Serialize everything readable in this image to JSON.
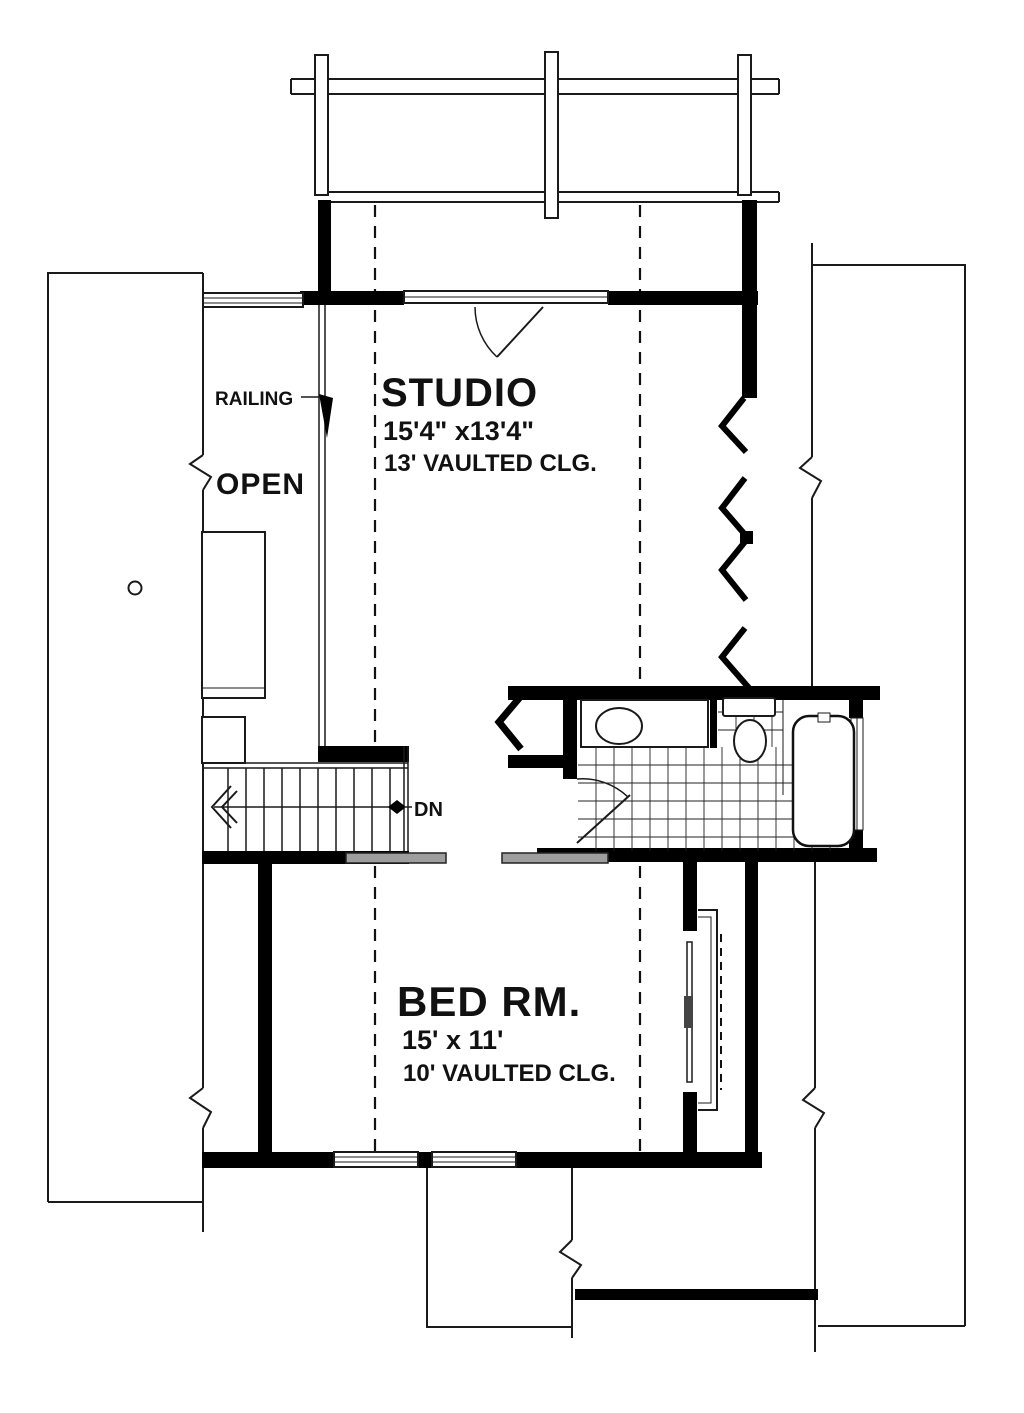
{
  "plan": {
    "labels": {
      "railing": "RAILING",
      "open": "OPEN",
      "down": "DN"
    },
    "rooms": {
      "studio": {
        "name": "STUDIO",
        "dimensions": "15'4\" x13'4\"",
        "ceiling": "13' VAULTED CLG."
      },
      "bedroom": {
        "name": "BED RM.",
        "dimensions": "15' x 11'",
        "ceiling": "10' VAULTED CLG."
      }
    },
    "colors": {
      "line": "#000000",
      "background": "#ffffff",
      "threshold_gray": "#9e9e9e"
    }
  }
}
